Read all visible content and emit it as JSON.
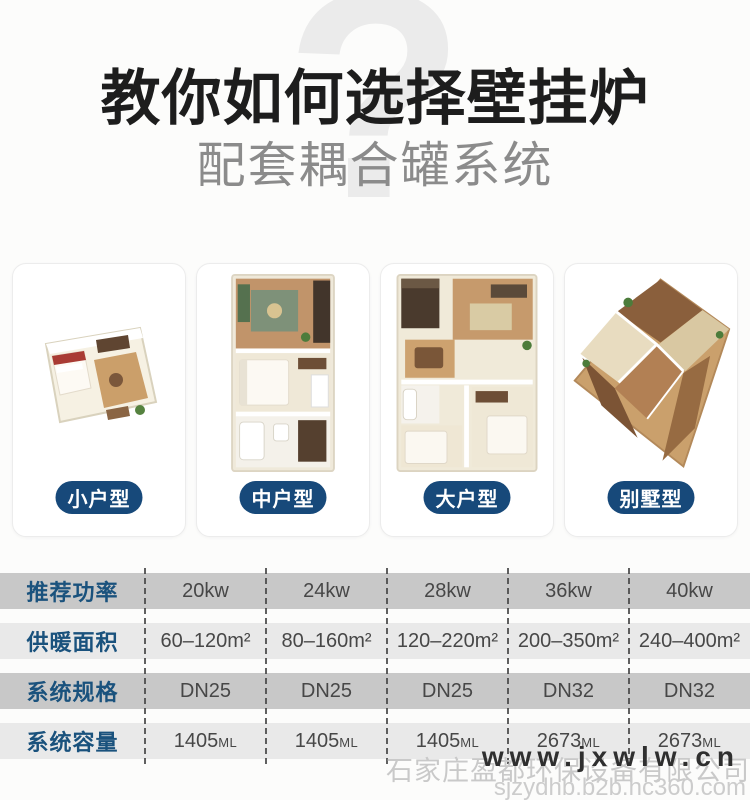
{
  "header": {
    "title": "教你如何选择壁挂炉",
    "subtitle": "配套耦合罐系统",
    "question_mark": "?"
  },
  "cards": [
    {
      "label": "小户型",
      "image": "floorplan-small"
    },
    {
      "label": "中户型",
      "image": "floorplan-medium"
    },
    {
      "label": "大户型",
      "image": "floorplan-large"
    },
    {
      "label": "别墅型",
      "image": "floorplan-villa"
    }
  ],
  "table": {
    "rows": [
      {
        "label": "推荐功率",
        "cells": [
          "20kw",
          "24kw",
          "28kw",
          "36kw",
          "40kw"
        ]
      },
      {
        "label": "供暖面积",
        "cells": [
          "60–120m²",
          "80–160m²",
          "120–220m²",
          "200–350m²",
          "240–400m²"
        ]
      },
      {
        "label": "系统规格",
        "cells": [
          "DN25",
          "DN25",
          "DN25",
          "DN32",
          "DN32"
        ]
      },
      {
        "label": "系统容量",
        "cells": [
          {
            "num": "1405",
            "unit": "ML"
          },
          {
            "num": "1405",
            "unit": "ML"
          },
          {
            "num": "1405",
            "unit": "ML"
          },
          {
            "num": "2673",
            "unit": "ML"
          },
          {
            "num": "2673",
            "unit": "ML"
          }
        ]
      }
    ]
  },
  "watermark": {
    "site": "www.jxwlw.cn",
    "company": "石家庄盈都环保设备有限公司",
    "store_url": "sjzydhb.b2b.hc360.com"
  },
  "colors": {
    "accent_blue": "#1a527d",
    "pill_navy": "#17497a",
    "row_dark": "#c8c8c8",
    "row_light": "#e9e9e9",
    "watermark_gray": "#c9c9c9"
  }
}
